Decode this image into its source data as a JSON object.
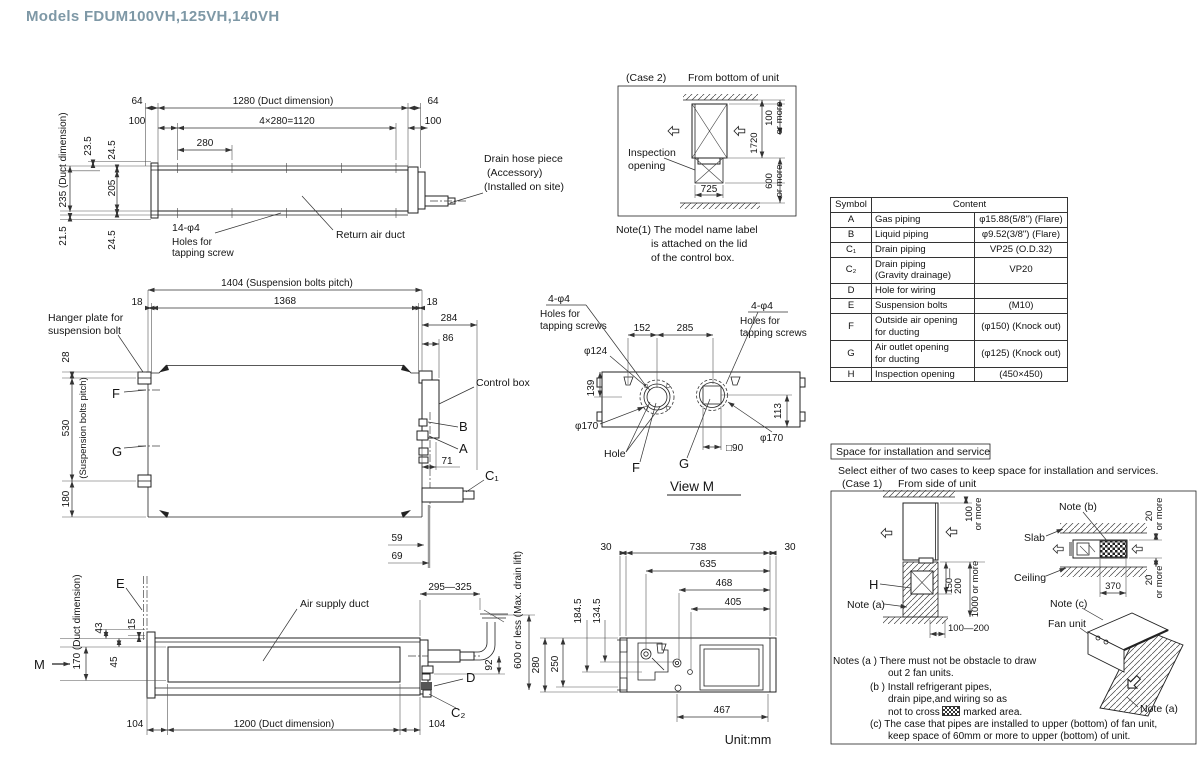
{
  "title": "Models  FDUM100VH,125VH,140VH",
  "accent": "#7e98a6",
  "fv": {
    "d235": "235 (Duct dimension)",
    "d23_5": "23.5",
    "d24_5a": "24.5",
    "d205": "205",
    "d24_5b": "24.5",
    "d21_5": "21.5",
    "d64l": "64",
    "d100l": "100",
    "d1280": "1280 (Duct dimension)",
    "d1120": "4×280=1120",
    "d280": "280",
    "d64r": "64",
    "d100r": "100",
    "holes1": "14-φ4",
    "holes2": "Holes for",
    "holes3": "tapping screw",
    "return_duct": "Return air duct",
    "drain1": "Drain hose piece",
    "drain2": "(Accessory)",
    "drain3": "(Installed on site)"
  },
  "c2": {
    "case_lbl": "(Case 2)",
    "view_lbl": "From bottom of unit",
    "insp1": "Inspection",
    "insp2": "opening",
    "d725": "725",
    "d1720": "1720",
    "d100": "100",
    "more1": "or more",
    "d600": "600",
    "more2": "or more",
    "n1": "Note(1)  The model name label",
    "n2": "is attached on the lid",
    "n3": "of the control box."
  },
  "tbl": {
    "h1": "Symbol",
    "h2": "Content",
    "rows": [
      {
        "s": "A",
        "d": "Gas piping",
        "v": "φ15.88(5/8\") (Flare)"
      },
      {
        "s": "B",
        "d": "Liquid piping",
        "v": "φ9.52(3/8\") (Flare)"
      },
      {
        "s": "C₁",
        "d": "Drain piping",
        "v": "VP25 (O.D.32)"
      },
      {
        "s": "C₂",
        "d": "Drain piping\n(Gravity drainage)",
        "v": "VP20"
      },
      {
        "s": "D",
        "d": "Hole for wiring",
        "v": ""
      },
      {
        "s": "E",
        "d": "Suspension bolts",
        "v": "(M10)"
      },
      {
        "s": "F",
        "d": "Outside air opening\nfor ducting",
        "v": "(φ150) (Knock out)"
      },
      {
        "s": "G",
        "d": "Air outlet opening\nfor ducting",
        "v": "(φ125) (Knock out)"
      },
      {
        "s": "H",
        "d": "Inspection opening",
        "v": "(450×450)"
      }
    ]
  },
  "pv": {
    "d1404": "1404 (Suspension bolts pitch)",
    "d18l": "18",
    "d1368": "1368",
    "d18r": "18",
    "d284": "284",
    "d86": "86",
    "d28": "28",
    "d530": "530",
    "d530b": "(Suspension bolts pitch)",
    "d180": "180",
    "hanger1": "Hanger plate for",
    "hanger2": "suspension bolt",
    "f": "F",
    "g": "G",
    "cbox": "Control box",
    "b": "B",
    "a": "A",
    "d71": "71",
    "c1": "C₁",
    "d59": "59",
    "d69": "69"
  },
  "vm": {
    "l1": "4-φ4",
    "l2": "Holes for",
    "l3": "tapping screws",
    "r1": "4-φ4",
    "r2": "Holes for",
    "r3": "tapping screws",
    "d152": "152",
    "d285": "285",
    "d124": "φ124",
    "d139": "139",
    "d170l": "φ170",
    "d170r": "φ170",
    "d113": "113",
    "d90": "□90",
    "hole": "Hole",
    "f": "F",
    "g": "G",
    "title": "View M"
  },
  "sv": {
    "e": "E",
    "m": "M",
    "d170": "170 (Duct dimension)",
    "d43": "43",
    "d15": "15",
    "d45": "45",
    "duct": "Air supply duct",
    "d104l": "104",
    "d1200": "1200 (Duct dimension)",
    "d104r": "104",
    "d295": "295—325",
    "d92": "92",
    "d": "D",
    "c2": "C₂"
  },
  "bv": {
    "d30l": "30",
    "d738": "738",
    "d30r": "30",
    "d635": "635",
    "d468": "468",
    "d405": "405",
    "d184": "184.5",
    "d134": "134.5",
    "d280": "280",
    "d250": "250",
    "d600": "600 or less  (Max. drain lift)",
    "d467": "467",
    "unit": "Unit:mm"
  },
  "inst": {
    "title": "Space for installation and service",
    "intro": "Select either of two cases to keep space for installation and services.",
    "case1": "(Case 1)",
    "case1b": "From side of unit",
    "d100": "100",
    "more1": "or more",
    "h": "H",
    "note_a": "Note (a)",
    "d150": "150—",
    "d200": "200",
    "d1000": "1000 or more",
    "d100_200": "100—200",
    "note_b": "Note (b)",
    "slab": "Slab",
    "ceiling": "Ceiling",
    "d370": "370",
    "d20a": "20",
    "more2": "or more",
    "d20b": "20",
    "more3": "or more",
    "note_c": "Note (c)",
    "fan": "Fan unit",
    "note_a2": "Note (a)"
  },
  "notes": {
    "l1": "Notes (a )  There must not be obstacle to draw",
    "l2": "out 2 fan units.",
    "l3": "(b )  Install refrigerant pipes,",
    "l4": "drain pipe,and wiring so as",
    "l5a": "not to cross",
    "l5b": "marked area.",
    "l6": "(c)  The case that pipes are installed to upper (bottom) of fan unit,",
    "l7": "keep space of 60mm or more to upper (bottom) of unit."
  }
}
